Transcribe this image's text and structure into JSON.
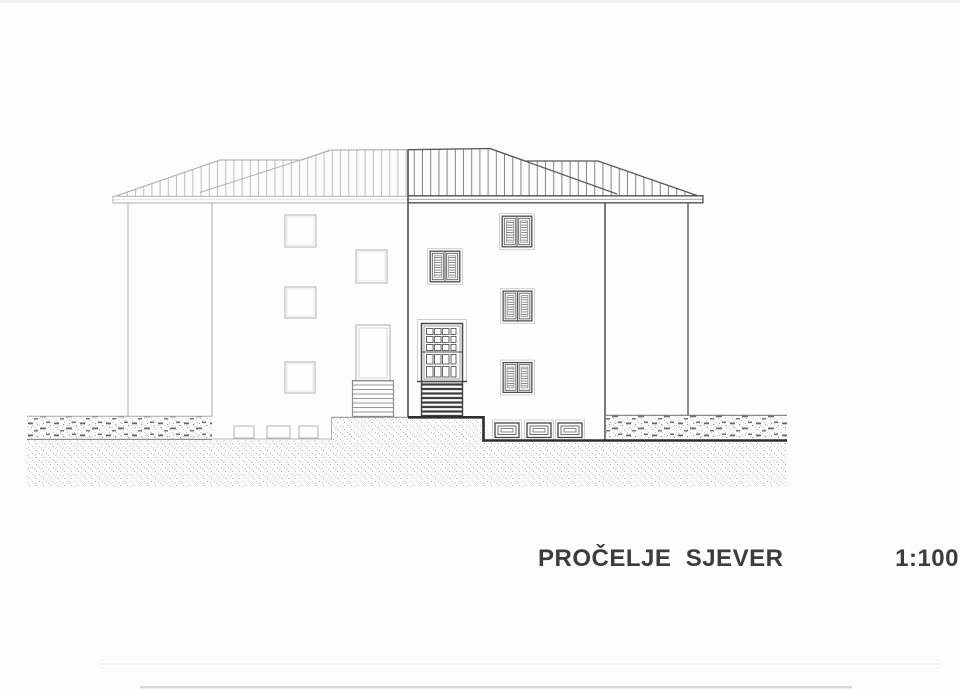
{
  "titleblock": {
    "title": "PROČELJE  SJEVER",
    "scale": "1:100"
  },
  "colors": {
    "paper": "#fdfdfd",
    "ink_light": "#b2b2b2",
    "ink_dark": "#4f4f4f",
    "terrain_line": "#2e2e2e",
    "text": "#3c3c3c"
  }
}
